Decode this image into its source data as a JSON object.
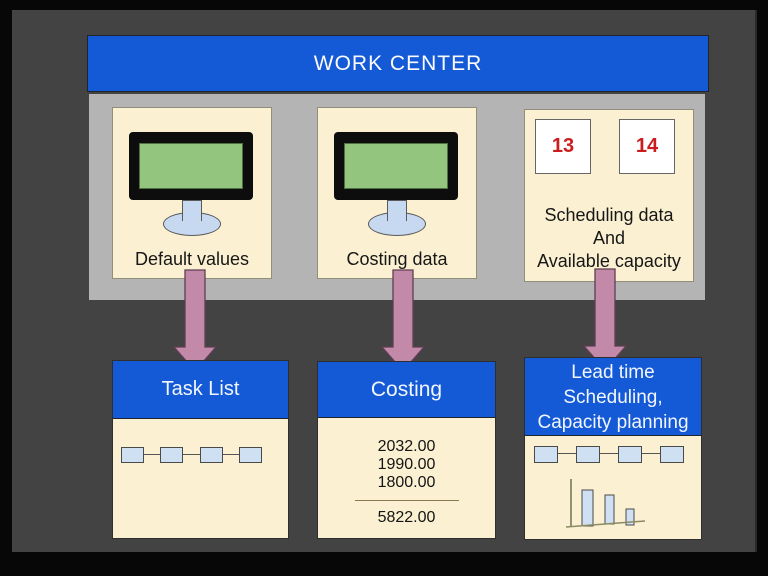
{
  "work_center": {
    "title": "WORK CENTER",
    "machines": [
      {
        "label": "Default values",
        "icon": "computer-monitor"
      },
      {
        "label": "Costing data",
        "icon": "computer-monitor"
      },
      {
        "badges": [
          "13",
          "14"
        ],
        "lines": [
          "Scheduling data",
          "And",
          "Available capacity"
        ]
      }
    ]
  },
  "outputs": {
    "task_list": {
      "title": "Task List",
      "icon": "process-chain"
    },
    "costing": {
      "title": "Costing",
      "values": [
        "2032.00",
        "1990.00",
        "1800.00"
      ],
      "total": "5822.00"
    },
    "lead_time": {
      "title_lines": [
        "Lead time",
        "Scheduling,",
        "Capacity planning"
      ],
      "icons": [
        "process-chain",
        "bar-chart"
      ]
    }
  },
  "colors": {
    "header_blue": "#145ad6",
    "container_gray": "#b4b4b4",
    "background_dark": "#434343",
    "card_cream": "#fbf0d1",
    "arrow_pink": "#c289a8",
    "monitor_green": "#94c57e",
    "chip_blue": "#cfe0f2",
    "badge_red": "#cb1d1d"
  }
}
